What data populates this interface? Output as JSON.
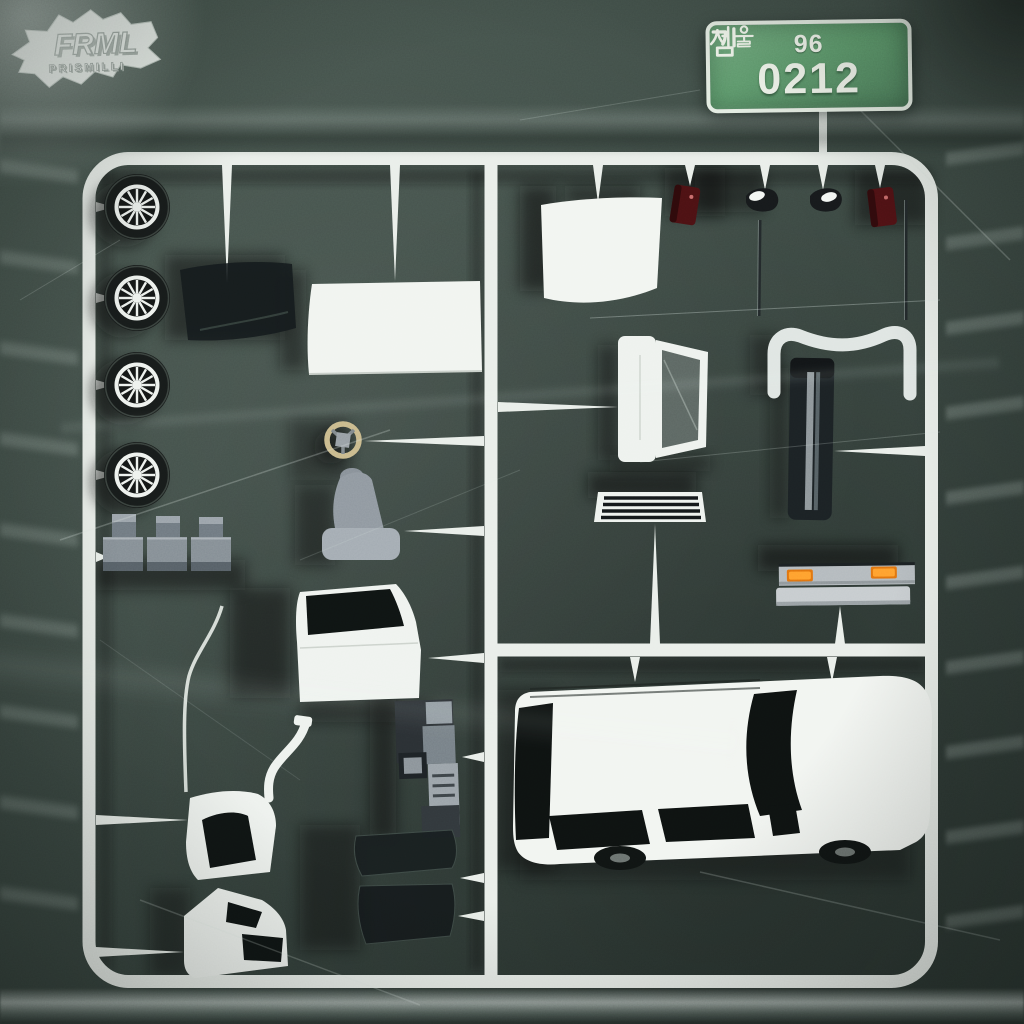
{
  "artwork": {
    "description": "Model-kit sprue of white car parts on dark green background wrapped in clear plastic",
    "background_color": "#3e4b45",
    "sprue_color": "#e9eee9"
  },
  "license_plate": {
    "region_hangul": "서울",
    "top_number": "96",
    "prefix_hangul": "김",
    "main_number": "0212",
    "plate_color": "#5f9a6d",
    "border_color": "#e3ebe1",
    "text_color": "#f1f6ec"
  },
  "logo": {
    "title": "FRML",
    "subtitle": "PRISMILLI",
    "color": "#ecf1ec"
  },
  "colors": {
    "indicator_orange": "#e0720f",
    "tail_light_red": "#4b1113",
    "seat_gray": "#9aa2aa",
    "steering_ring_tan": "#c9b98b"
  },
  "parts": [
    {
      "id": "wheels",
      "label": "Wheel with spoked rim",
      "count": 4,
      "color": "#171b1a"
    },
    {
      "id": "mud-flap",
      "label": "Dark curved flap",
      "count": 1,
      "color": "#14191b"
    },
    {
      "id": "roof-panel",
      "label": "Roof panel",
      "count": 1,
      "color": "#f1f4f0"
    },
    {
      "id": "windshield",
      "label": "Windshield panel",
      "count": 1,
      "color": "#f2f5f1"
    },
    {
      "id": "steering-wheel",
      "label": "Steering wheel",
      "count": 1,
      "color": "#c9b98b"
    },
    {
      "id": "seat",
      "label": "Seat",
      "count": 1,
      "color": "#9aa2aa"
    },
    {
      "id": "engine-blocks",
      "label": "Engine blocks",
      "count": 3,
      "color": "#848d94"
    },
    {
      "id": "tail-lights",
      "label": "Tail lights",
      "count": 2,
      "color": "#4b1113"
    },
    {
      "id": "side-mirrors",
      "label": "Side mirrors",
      "count": 2,
      "color": "#16191b"
    },
    {
      "id": "antennas",
      "label": "Antenna rods",
      "count": 2,
      "color": "#22282a"
    },
    {
      "id": "rear-bumper",
      "label": "Rear bumper",
      "count": 1,
      "color": "#dfe5e2"
    },
    {
      "id": "rear-window-frame",
      "label": "Rear hatch window frame",
      "count": 1,
      "color": "#eef2ee"
    },
    {
      "id": "trim-strip",
      "label": "Dark trim strip",
      "count": 1,
      "color": "#1b2124"
    },
    {
      "id": "grille",
      "label": "Front grille",
      "count": 1,
      "color": "#eef2ee"
    },
    {
      "id": "front-bumper",
      "label": "Front bumper with orange indicators",
      "count": 1,
      "color": "#b3b9bd"
    },
    {
      "id": "door",
      "label": "Front door",
      "count": 1,
      "color": "#eff3ef"
    },
    {
      "id": "dashboard",
      "label": "Dashboard console",
      "count": 1,
      "color": "#767f86"
    },
    {
      "id": "fender",
      "label": "Front fender",
      "count": 1,
      "color": "#eef2ee"
    },
    {
      "id": "quarter-panel",
      "label": "Rear quarter panel",
      "count": 1,
      "color": "#eef2ee"
    },
    {
      "id": "window-glass",
      "label": "Window glass panes",
      "count": 2,
      "color": "#181e1f"
    },
    {
      "id": "car-body",
      "label": "Station wagon body shell",
      "count": 1,
      "color": "#f2f5f1"
    }
  ]
}
